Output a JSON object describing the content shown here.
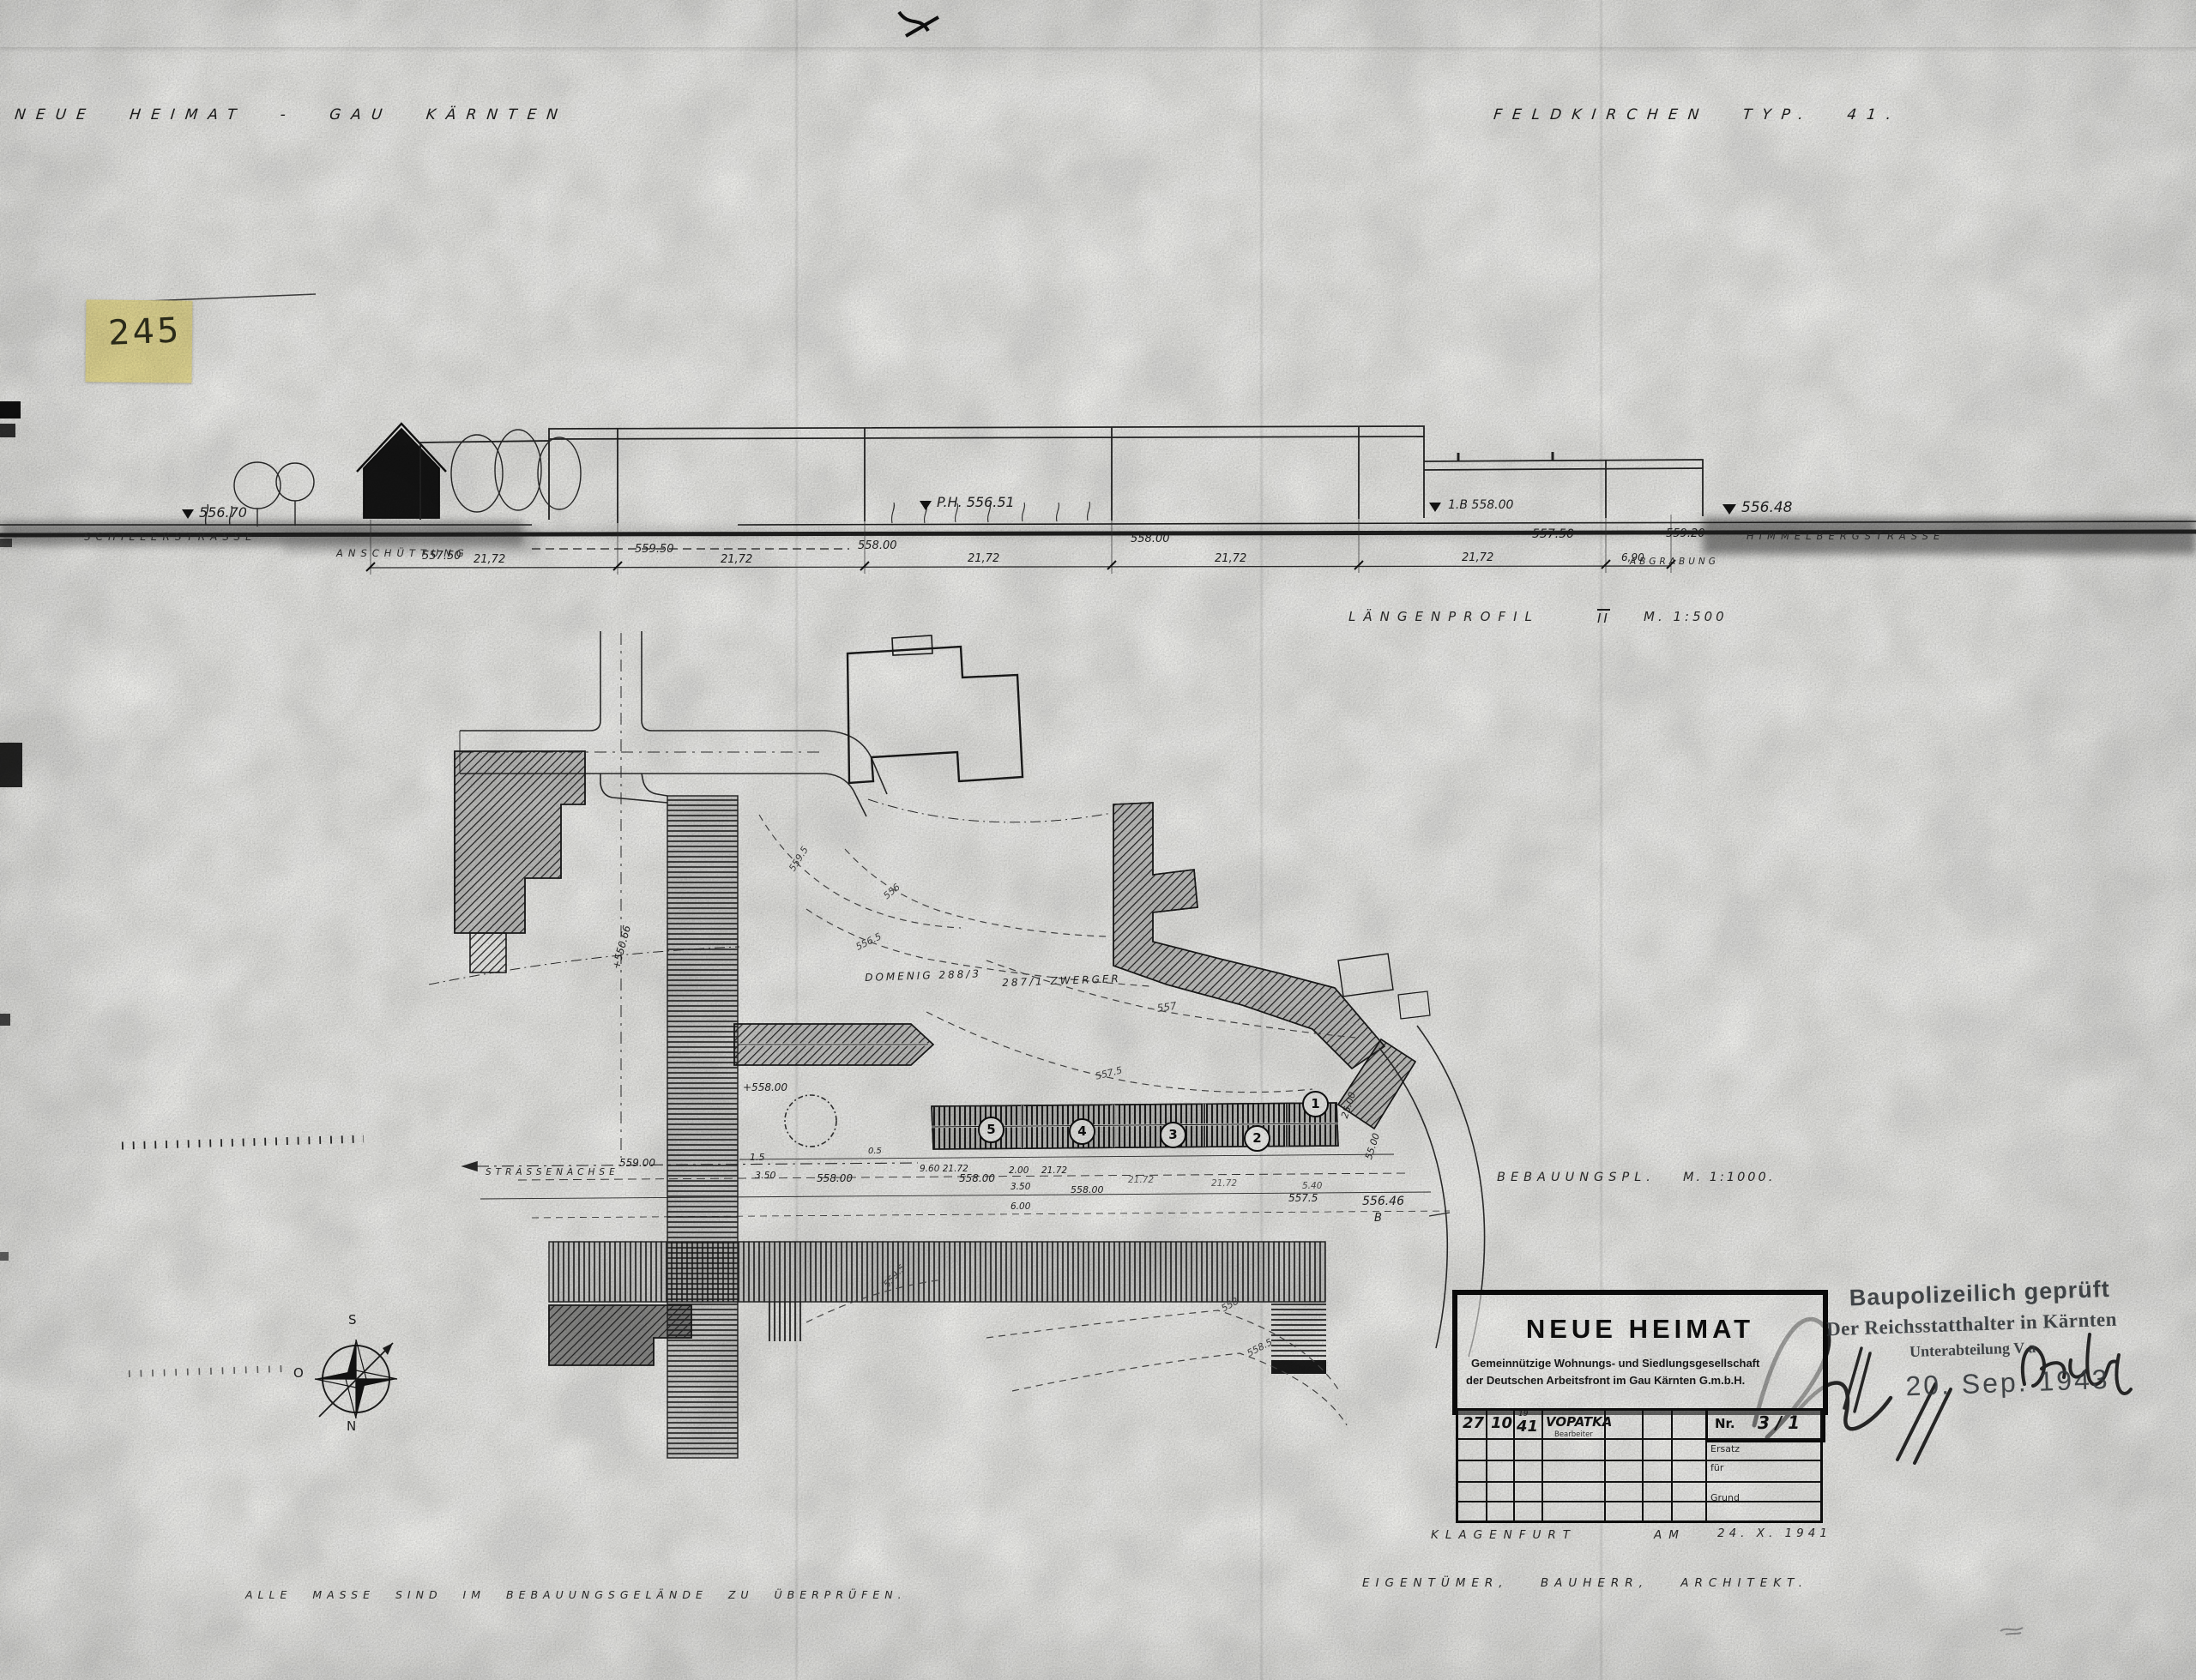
{
  "header": {
    "left": "NEUE HEIMAT - GAU KÄRNTEN",
    "right": "FELDKIRCHEN TYP. 41."
  },
  "sticky_note": {
    "number": "245"
  },
  "profile": {
    "title_word": "LÄNGENPROFIL",
    "title_roman": "II",
    "title_scale": "M. 1:500",
    "street_left": "SCHILLERSTRASSE",
    "fill_note": "ANSCHÜTTUNG",
    "cut_note": "ABGRABUNG",
    "street_right": "HIMMELBERGSTRASSE",
    "e1": "556.70",
    "e2": "557.50",
    "e3": "559.50",
    "e4": "558.00",
    "e5": "P.H. 556.51",
    "e6": "558.00",
    "e7": "1.B 558.00",
    "e8": "557.50",
    "e9": "559.20",
    "e10": "556.48",
    "dims": [
      "21,72",
      "21,72",
      "21,72",
      "21,72",
      "21,72",
      "6,90"
    ]
  },
  "plan": {
    "title_name": "BEBAUUNGSPL.",
    "title_scale": "M. 1:1000.",
    "street_axis": "STRASSENACHSE",
    "parcel_left": "DOMENIG 288/3",
    "parcel_right": "287/1 ZWERGER",
    "unit_numbers": [
      "5",
      "4",
      "3",
      "2",
      "1"
    ],
    "contours": [
      "559.5",
      "556",
      "556.5",
      "557",
      "557.5",
      "558",
      "558.5",
      "559.5"
    ],
    "labels": {
      "road_elev": "+550.66",
      "spot_tree": "+558.00",
      "spot_axis": "559.00",
      "off1": "1.5",
      "off2": "3.50",
      "spot1": "558.00",
      "off3": "0.5",
      "spot2": "558.00",
      "dim1": "9.60  21.72",
      "dim2": "2.00",
      "dim3": "21.72",
      "off4": "3.50",
      "spot3": "558.00",
      "off5": "6.00",
      "dim4": "21.72",
      "dim5": "21.72",
      "dim6": "5.40",
      "spot4": "557.5",
      "spot5": "556.46",
      "point_b": "B",
      "dim7": "25.00",
      "dim8": "55.00"
    }
  },
  "compass": {
    "s": "S",
    "o": "O",
    "n": "N"
  },
  "title_block": {
    "company": "NEUE HEIMAT",
    "line1": "Gemeinnützige Wohnungs- und Siedlungsgesellschaft",
    "line2": "der Deutschen Arbeitsfront im Gau Kärnten G.m.b.H.",
    "day": "27",
    "month": "10",
    "year_small": "19",
    "year": "41",
    "name": "VOPATKA",
    "name_sub": "Bearbeiter",
    "nr_label": "Nr.",
    "nr_value": "3 / 1",
    "side1": "Ersatz",
    "side2": "für",
    "side3": "Grund"
  },
  "stamp": {
    "line1": "Baupolizeilich geprüft",
    "line2": "Der Reichsstatthalter in Kärnten",
    "line3": "Unterabteilung V a",
    "date": "20. Sep. 1943"
  },
  "footer": {
    "place": "KLAGENFURT",
    "am": "AM",
    "date": "24. X. 1941",
    "roles": "EIGENTÜMER,   BAUHERR,   ARCHITEKT.",
    "note": "ALLE MASSE SIND IM BEBAUUNGSGELÄNDE ZU ÜBERPRÜFEN."
  }
}
